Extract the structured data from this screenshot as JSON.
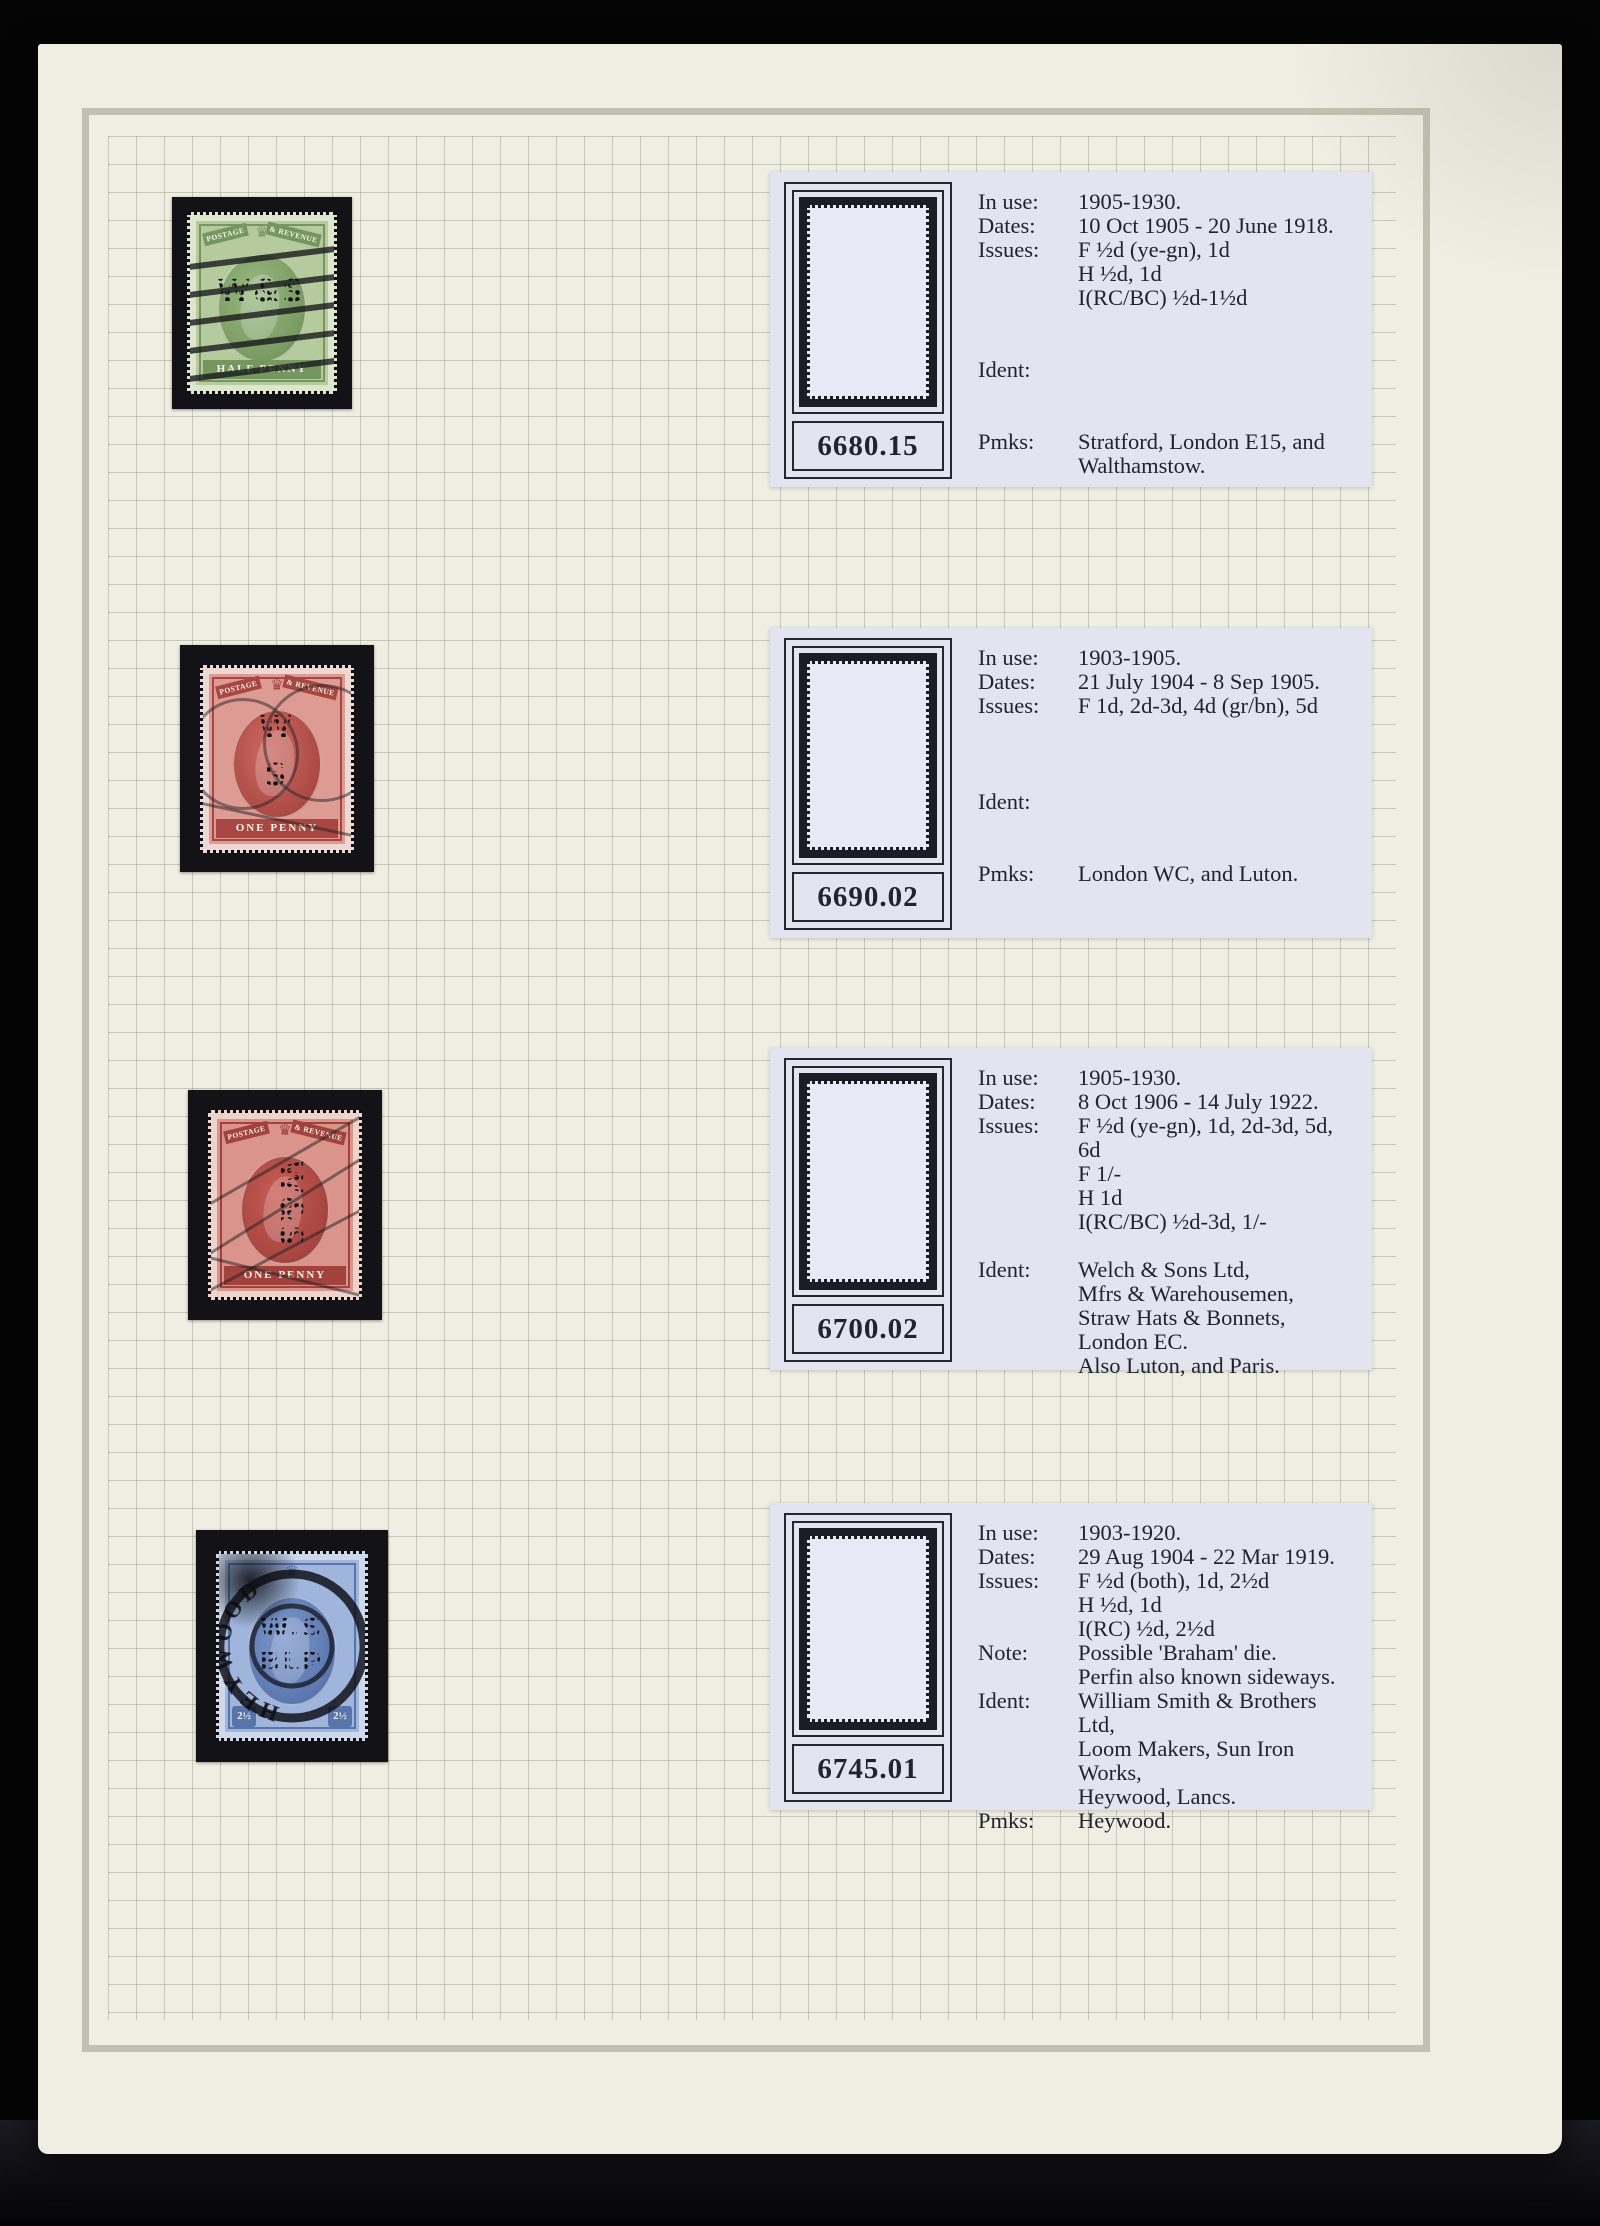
{
  "page": {
    "description": "Stamp album page with W&S perfin stamps and catalogue cards",
    "colors": {
      "backdrop": "#050506",
      "paper": "#efeee3",
      "frame_line": "#bfc2b2",
      "grid_line": "#8a9a6e",
      "card_background": "#e4e4f1",
      "ink": "#23232e",
      "mount_black": "#121217"
    }
  },
  "stamps": [
    {
      "id": "half-penny-green",
      "top_left_text": "POSTAGE",
      "top_right_text": "& REVENUE",
      "denomination_label": "HALF PENNY",
      "perfin_text": "W&S",
      "cancel_type": "machine bars",
      "colors": {
        "paper": "#dde5cf",
        "body": "#b5cb9e",
        "mid": "#9aba82",
        "dark": "#76965f"
      }
    },
    {
      "id": "one-penny-red-1",
      "top_left_text": "POSTAGE",
      "top_right_text": "& REVENUE",
      "denomination_label": "ONE PENNY",
      "perfin_line1": "W",
      "perfin_line2": "S",
      "cancel_type": "double circle postmark",
      "colors": {
        "paper": "#edd8d3",
        "body": "#dd9b94",
        "mid": "#cc6a62",
        "dark": "#a84641"
      }
    },
    {
      "id": "one-penny-red-2",
      "top_left_text": "POSTAGE",
      "top_right_text": "& REVENUE",
      "denomination_label": "ONE PENNY",
      "perfin_text": "W&S",
      "cancel_type": "diagonal lines",
      "colors": {
        "paper": "#ecd4cd",
        "body": "#da948c",
        "mid": "#c75e55",
        "dark": "#a2423c"
      }
    },
    {
      "id": "two-half-pence-blue",
      "top_left_text": "POSTAGE",
      "top_right_text": "& REVENUE",
      "denomination_label": "",
      "value_text": "2½",
      "perfin_line1": "W.S",
      "perfin_line2": "BLP",
      "postmark_text": "HEYWOOD",
      "cancel_type": "heavy circular datestamp",
      "colors": {
        "paper": "#cdd8eb",
        "body": "#9fb5dc",
        "mid": "#7b97cb",
        "dark": "#5874ab"
      }
    }
  ],
  "cards": [
    {
      "number": "6680.15",
      "perfin": {
        "lines": [
          "W&S"
        ],
        "rotated": false
      },
      "rows": [
        {
          "label": "In use:",
          "text": "1905-1930."
        },
        {
          "label": "Dates:",
          "text": "10 Oct 1905 - 20 June 1918."
        },
        {
          "label": "Issues:",
          "text": "F ½d (ye-gn), 1d"
        },
        {
          "label": "",
          "text": "H ½d, 1d"
        },
        {
          "label": "",
          "text": "I(RC/BC) ½d-1½d"
        },
        {
          "label": "",
          "text": ""
        },
        {
          "label": "",
          "text": ""
        },
        {
          "label": "Ident:",
          "text": ""
        },
        {
          "label": "",
          "text": ""
        },
        {
          "label": "",
          "text": ""
        },
        {
          "label": "Pmks:",
          "text": "Stratford, London E15, and"
        },
        {
          "label": "",
          "text": "Walthamstow."
        }
      ]
    },
    {
      "number": "6690.02",
      "perfin": {
        "lines": [
          "W",
          "S"
        ],
        "rotated": false
      },
      "rows": [
        {
          "label": "In use:",
          "text": "1903-1905."
        },
        {
          "label": "Dates:",
          "text": "21 July 1904 - 8 Sep 1905."
        },
        {
          "label": "Issues:",
          "text": "F 1d, 2d-3d, 4d (gr/bn), 5d"
        },
        {
          "label": "",
          "text": ""
        },
        {
          "label": "",
          "text": ""
        },
        {
          "label": "",
          "text": ""
        },
        {
          "label": "Ident:",
          "text": ""
        },
        {
          "label": "",
          "text": ""
        },
        {
          "label": "",
          "text": ""
        },
        {
          "label": "Pmks:",
          "text": "London WC, and Luton."
        }
      ]
    },
    {
      "number": "6700.02",
      "perfin": {
        "lines": [
          "W&S"
        ],
        "rotated": true
      },
      "rows": [
        {
          "label": "In use:",
          "text": "1905-1930."
        },
        {
          "label": "Dates:",
          "text": "8 Oct 1906 - 14 July 1922."
        },
        {
          "label": "Issues:",
          "text": "F ½d (ye-gn), 1d, 2d-3d, 5d, 6d"
        },
        {
          "label": "",
          "text": "F 1/-"
        },
        {
          "label": "",
          "text": "H 1d"
        },
        {
          "label": "",
          "text": "I(RC/BC) ½d-3d, 1/-"
        },
        {
          "label": "",
          "text": ""
        },
        {
          "label": "Ident:",
          "text": "Welch & Sons Ltd,"
        },
        {
          "label": "",
          "text": "Mfrs & Warehousemen,"
        },
        {
          "label": "",
          "text": "Straw Hats & Bonnets,"
        },
        {
          "label": "",
          "text": "London EC."
        },
        {
          "label": "",
          "text": "Also Luton, and Paris."
        }
      ]
    },
    {
      "number": "6745.01",
      "perfin": {
        "lines": [
          "W.S",
          "BLP"
        ],
        "rotated": false
      },
      "rows": [
        {
          "label": "In use:",
          "text": "1903-1920."
        },
        {
          "label": "Dates:",
          "text": "29 Aug 1904 - 22 Mar 1919."
        },
        {
          "label": "Issues:",
          "text": "F ½d (both), 1d, 2½d"
        },
        {
          "label": "",
          "text": "H ½d, 1d"
        },
        {
          "label": "",
          "text": "I(RC) ½d, 2½d"
        },
        {
          "label": "Note:",
          "text": "Possible 'Braham' die."
        },
        {
          "label": "",
          "text": "Perfin also known sideways."
        },
        {
          "label": "Ident:",
          "text": "William Smith & Brothers Ltd,"
        },
        {
          "label": "",
          "text": "Loom Makers, Sun Iron Works,"
        },
        {
          "label": "",
          "text": "Heywood, Lancs."
        },
        {
          "label": "Pmks:",
          "text": "Heywood."
        }
      ]
    }
  ]
}
